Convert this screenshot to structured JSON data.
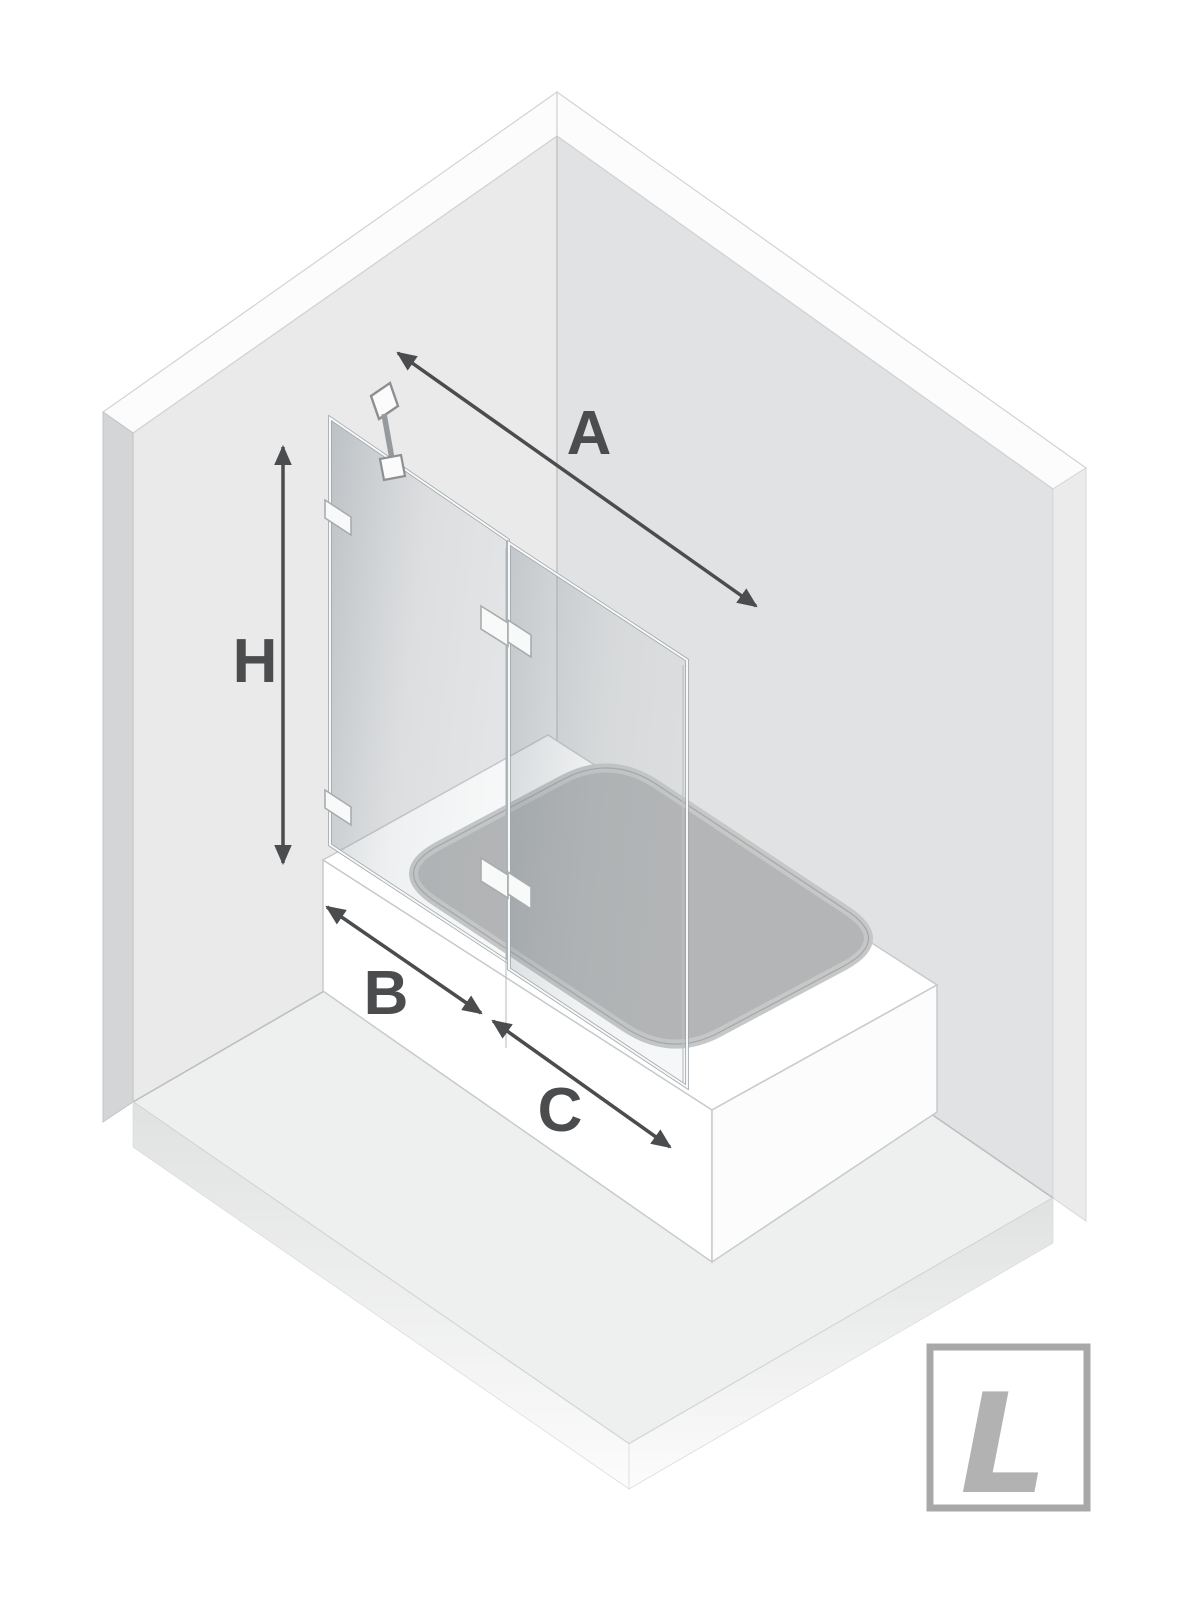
{
  "diagram": {
    "kind": "isometric-bathtub-shower-screen-dimension-diagram",
    "dimension_labels": {
      "a": "A",
      "h": "H",
      "b": "B",
      "c": "C"
    },
    "logo_letter": "L",
    "colors": {
      "background": "#ffffff",
      "left_wall": "#eaeaeb",
      "right_wall": "#e1e2e3",
      "floor": "#eeefef",
      "tub": "#ffffff",
      "basin": "#b3b5b6",
      "glass_tint": "#9aa4aa",
      "arrow": "#4b4c4e",
      "logo_gray": "#b2b2b2"
    }
  }
}
